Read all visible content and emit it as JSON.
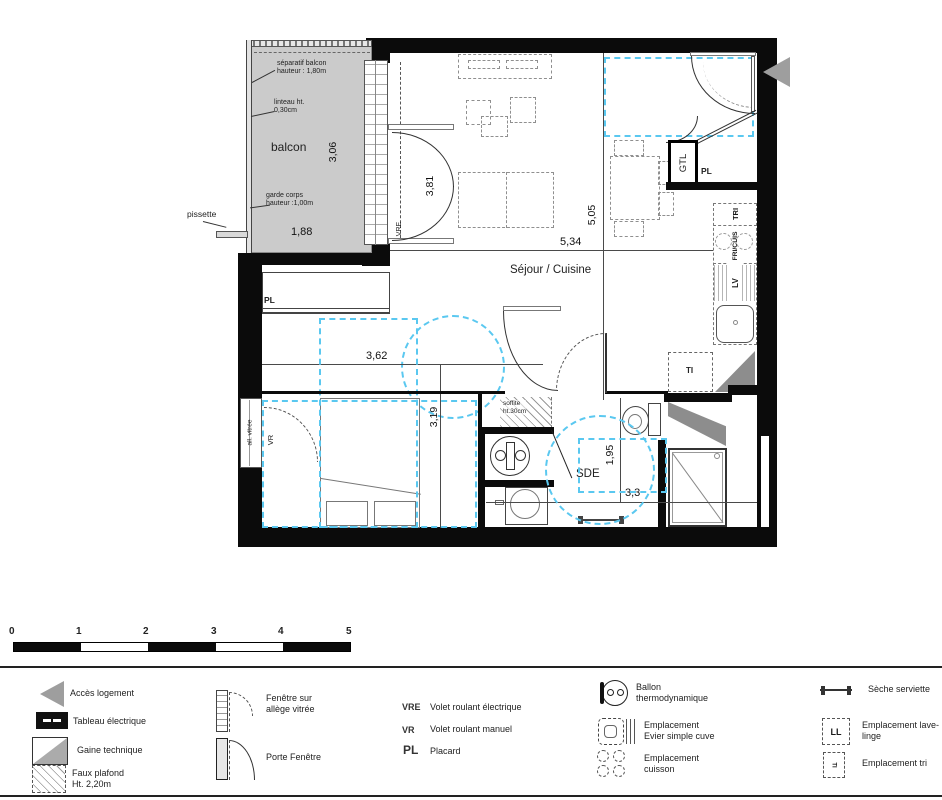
{
  "plan": {
    "balcon": {
      "separatif": "séparatif balcon\nhauteur : 1,80m",
      "linteau": "linteau ht.\n0,30cm",
      "name": "balcon",
      "garde_corps": "garde corps\nhauteur :1,00m",
      "width": "1,88",
      "height": "3,06",
      "pissette": "pissette"
    },
    "sejour": {
      "name": "Séjour / Cuisine",
      "width": "5,34",
      "height": "5,05",
      "bay": "3,81",
      "vre": "VRE",
      "gtl": "GTL",
      "pl": "PL",
      "tri": "TRI",
      "fri_cuis": "FRI/CUIS",
      "lv": "LV",
      "ti": "TI"
    },
    "chambre": {
      "name": "Chambre",
      "pl": "PL",
      "width": "3,62",
      "height": "3,19",
      "allege": "all. vitrée",
      "vr": "VR"
    },
    "sde": {
      "name": "SDE",
      "soffite": "soffite\nht.30cm",
      "height": "1,95",
      "width": "3,3"
    }
  },
  "scalebar": {
    "ticks": [
      "0",
      "1",
      "2",
      "3",
      "4",
      "5"
    ]
  },
  "legend": {
    "acces": "Accès  logement",
    "tableau": "Tableau électrique",
    "gaine": "Gaine technique",
    "faux_plafond": "Faux plafond\nHt. 2,20m",
    "fenetre": "Fenêtre sur\nallège vitrée",
    "porte_fenetre": "Porte Fenêtre",
    "vre_abbr": "VRE",
    "vre": "Volet roulant électrique",
    "vr_abbr": "VR",
    "vr": "Volet roulant manuel",
    "pl_abbr": "PL",
    "pl": "Placard",
    "ballon": "Ballon\nthermodynamique",
    "evier": "Emplacement\nEvier simple cuve",
    "cuisson": "Emplacement\ncuisson",
    "seche": "Sèche serviette",
    "lave_linge": "Emplacement lave-\nlinge",
    "ll": "LL",
    "tri_glyph": "TI",
    "tri": "Emplacement tri"
  }
}
